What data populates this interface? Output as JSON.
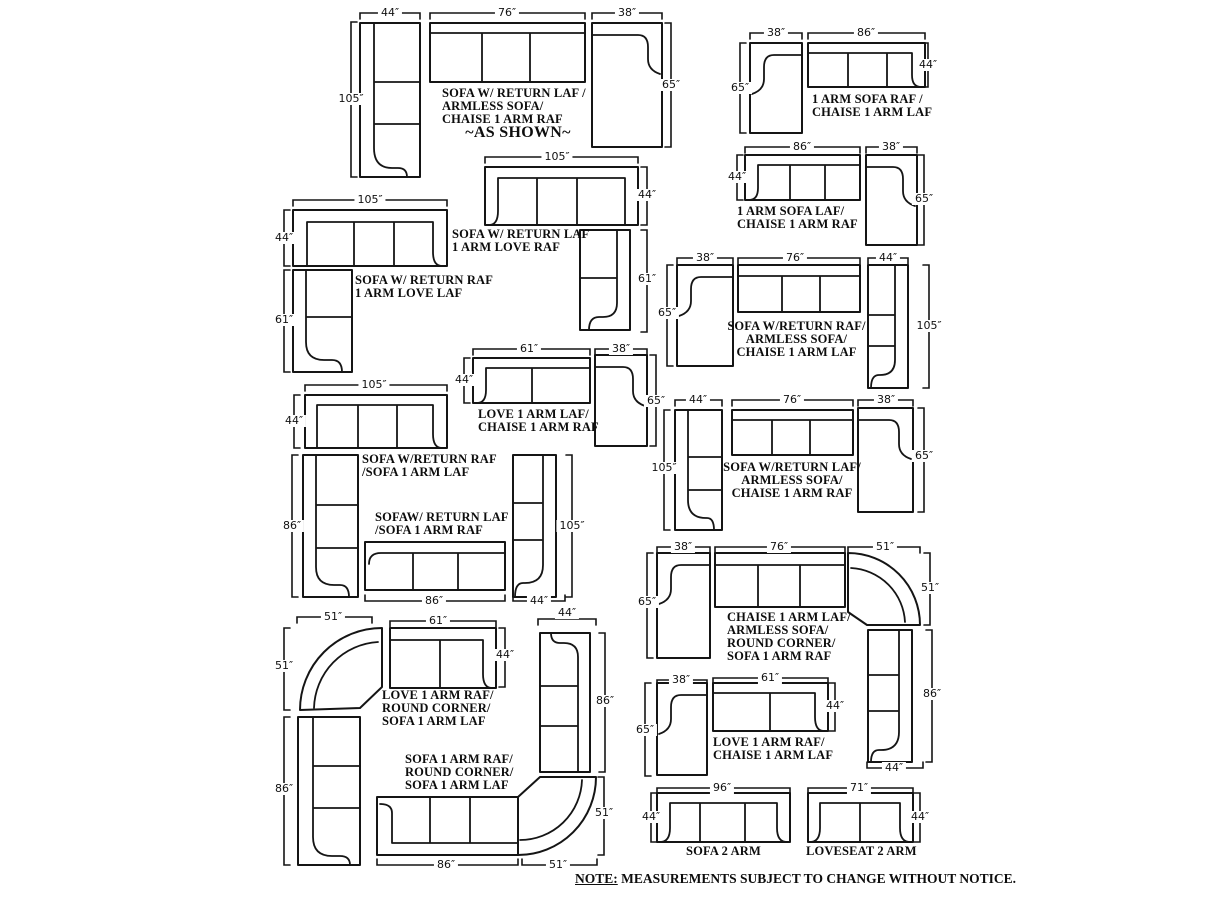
{
  "groups": [
    {
      "name": "sofa-return-laf-armless-chaise-raf-as-shown",
      "label": [
        "SOFA W/ RETURN LAF /",
        "ARMLESS SOFA/",
        "CHAISE 1 ARM RAF"
      ],
      "sublabel": "~AS SHOWN~",
      "dims": [
        "44″",
        "76″",
        "38″",
        "105″",
        "65″"
      ]
    },
    {
      "name": "one-arm-sofa-raf-chaise-laf",
      "label": [
        "1 ARM SOFA RAF /",
        "CHAISE 1 ARM LAF"
      ],
      "dims": [
        "38″",
        "86″",
        "65″",
        "44″"
      ]
    },
    {
      "name": "one-arm-sofa-laf-chaise-raf",
      "label": [
        "1 ARM SOFA LAF/",
        "CHAISE 1 ARM RAF"
      ],
      "dims": [
        "86″",
        "38″",
        "44″",
        "65″"
      ]
    },
    {
      "name": "sofa-return-raf-love-laf",
      "label": [
        "SOFA W/ RETURN RAF",
        "1 ARM LOVE LAF"
      ],
      "dims": [
        "105″",
        "44″",
        "61″"
      ]
    },
    {
      "name": "sofa-return-laf-love-raf",
      "label": [
        "SOFA W/ RETURN LAF",
        "1 ARM LOVE RAF"
      ],
      "dims": [
        "105″",
        "44″",
        "61″"
      ]
    },
    {
      "name": "sofa-return-raf-armless-chaise-laf",
      "label": [
        "SOFA W/RETURN RAF/",
        "ARMLESS SOFA/",
        "CHAISE 1 ARM LAF"
      ],
      "dims": [
        "38″",
        "76″",
        "44″",
        "65″",
        "105″"
      ]
    },
    {
      "name": "love-laf-chaise-raf",
      "label": [
        "LOVE 1 ARM LAF/",
        "CHAISE 1 ARM RAF"
      ],
      "dims": [
        "61″",
        "38″",
        "44″",
        "65″"
      ]
    },
    {
      "name": "sofa-return-laf-armless-chaise-raf",
      "label": [
        "SOFA W/RETURN LAF/",
        "ARMLESS SOFA/",
        "CHAISE 1 ARM RAF"
      ],
      "dims": [
        "44″",
        "76″",
        "38″",
        "105″",
        "65″"
      ]
    },
    {
      "name": "sofa-return-raf-sofa-laf-and-mirror",
      "label": [
        "SOFA W/RETURN RAF",
        "/SOFA 1 ARM LAF"
      ],
      "label2": [
        "SOFAW/ RETURN LAF",
        "/SOFA 1 ARM RAF"
      ],
      "dims": [
        "105″",
        "44″",
        "86″",
        "86″",
        "44″",
        "105″"
      ]
    },
    {
      "name": "chaise-laf-armless-round-corner-sofa-raf",
      "label": [
        "CHAISE 1 ARM LAF/",
        "ARMLESS SOFA/",
        "ROUND CORNER/",
        "SOFA 1 ARM RAF"
      ],
      "dims": [
        "38″",
        "76″",
        "51″",
        "65″",
        "51″",
        "86″",
        "44″"
      ]
    },
    {
      "name": "love-raf-round-corner-sofa-laf",
      "label": [
        "LOVE 1 ARM RAF/",
        "ROUND CORNER/",
        "SOFA 1 ARM LAF"
      ],
      "dims": [
        "51″",
        "51″",
        "61″",
        "44″",
        "44″",
        "86″"
      ]
    },
    {
      "name": "sofa-raf-round-corner-sofa-laf",
      "label": [
        "SOFA 1 ARM RAF/",
        "ROUND CORNER/",
        "SOFA 1 ARM LAF"
      ],
      "dims": [
        "86″",
        "86″",
        "51″",
        "51″"
      ]
    },
    {
      "name": "love-raf-chaise-laf",
      "label": [
        "LOVE 1 ARM RAF/",
        "CHAISE 1 ARM LAF"
      ],
      "dims": [
        "38″",
        "61″",
        "44″",
        "65″"
      ]
    },
    {
      "name": "sofa-2-arm",
      "label": [
        "SOFA 2 ARM"
      ],
      "dims": [
        "96″",
        "44″"
      ]
    },
    {
      "name": "loveseat-2-arm",
      "label": [
        "LOVESEAT 2 ARM"
      ],
      "dims": [
        "71″",
        "44″"
      ]
    }
  ],
  "note": {
    "label": "NOTE:",
    "text": "MEASUREMENTS SUBJECT TO CHANGE WITHOUT NOTICE."
  }
}
